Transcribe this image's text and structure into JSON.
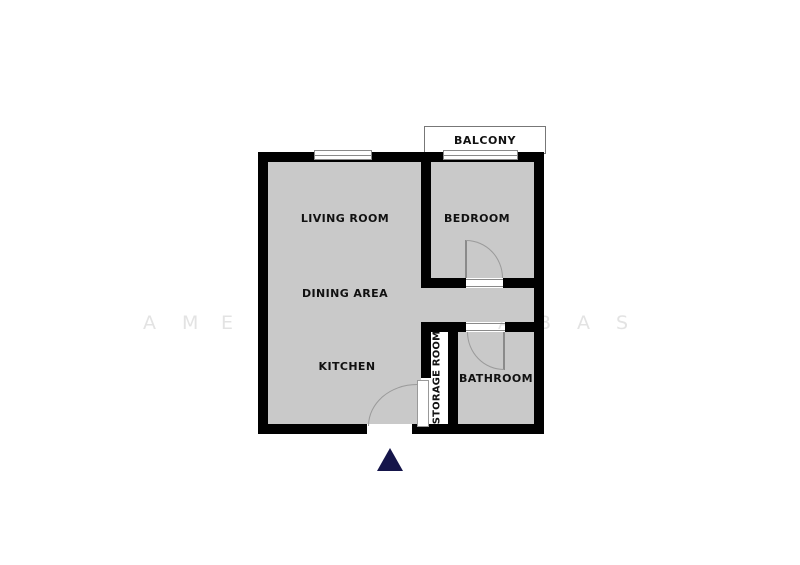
{
  "watermark": {
    "color": "#e3e3e3",
    "letters": [
      {
        "char": "A",
        "x": 143
      },
      {
        "char": "M",
        "x": 182
      },
      {
        "char": "E",
        "x": 221
      },
      {
        "char": "A",
        "x": 498
      },
      {
        "char": "B",
        "x": 538
      },
      {
        "char": "A",
        "x": 577
      },
      {
        "char": "S",
        "x": 616
      }
    ]
  },
  "floor_plan": {
    "rooms": {
      "living_room": {
        "label": "LIVING ROOM"
      },
      "dining_area": {
        "label": "DINING AREA"
      },
      "kitchen": {
        "label": "KITCHEN"
      },
      "bedroom": {
        "label": "BEDROOM"
      },
      "bathroom": {
        "label": "BATHROOM"
      },
      "storage_room": {
        "label": "STORAGE ROOM"
      },
      "balcony": {
        "label": "BALCONY"
      }
    },
    "colors": {
      "floor": "#c9c9c9",
      "wall": "#000000",
      "outline": "#8a8a8a",
      "entrance_arrow": "#15154a"
    }
  }
}
